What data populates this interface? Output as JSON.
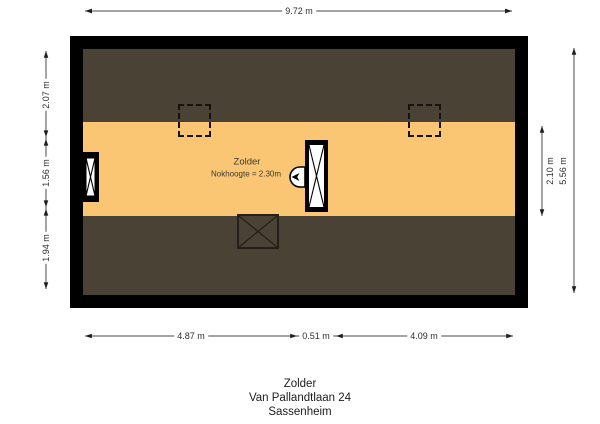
{
  "plan": {
    "room_label": "Zolder",
    "room_note": "Nokhoogte = 2.30m"
  },
  "dims": {
    "top": "9.72 m",
    "bottom_left": "4.87 m",
    "bottom_mid": "0.51 m",
    "bottom_right": "4.09 m",
    "left_top": "2.07 m",
    "left_mid": "1.56 m",
    "left_bottom": "1.94 m",
    "right_inner": "2.10 m",
    "right_outer": "5.56 m"
  },
  "title_block": {
    "line1": "Zolder",
    "line2": "Van Pallandtlaan 24",
    "line3": "Sassenheim"
  },
  "colors": {
    "wall": "#000000",
    "sloped_roof": "#4a4335",
    "floor": "#fbc674",
    "background": "#ffffff",
    "dimension_line": "#4a4a4a",
    "text": "#2e2e2e"
  },
  "icons": {
    "chimney_cross": "X-cross",
    "ventilation_fan": "left-dart",
    "stair_hatch_cross": "X-cross",
    "roof_window": "dashed-square"
  }
}
